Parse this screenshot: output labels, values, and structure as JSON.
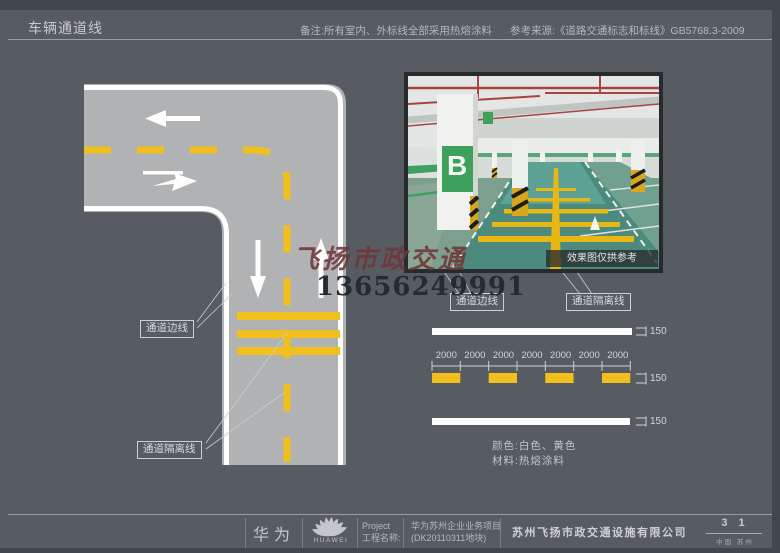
{
  "header": {
    "title": "车辆通道线",
    "note": "备注:所有室内、外标线全部采用热熔涂料",
    "reference": "参考来源:《道路交通标志和标线》GB5768.3-2009"
  },
  "diagram": {
    "callout_edge_line": "通道边线",
    "callout_separator_line": "通道隔离线"
  },
  "photo": {
    "pillar_sign": "B",
    "caption": "效果图仅拱参考",
    "callout_edge_line": "通道边线",
    "callout_separator_line": "通道隔离线"
  },
  "dimensions": {
    "segment_labels": [
      "2000",
      "2000",
      "2000",
      "2000",
      "2000",
      "2000",
      "2000"
    ],
    "width_label": "150"
  },
  "specs": {
    "color_line": "颜色:白色、黄色",
    "material_line": "材料:热熔涂料"
  },
  "watermark": {
    "name": "飞扬市政交通",
    "phone": "13656249991"
  },
  "footer": {
    "huawei_cn": "华为",
    "huawei_en": "HUAWEI",
    "project_label_en": "Project",
    "project_label_cn": "工程名称:",
    "project_name": "华为苏州企业业务项目",
    "project_code": "(DK20110311地块)",
    "company": "苏州飞扬市政交通设施有限公司",
    "page_number": "3 1",
    "location": "中国  苏州"
  },
  "colors": {
    "marking_yellow": "#F1C01D",
    "marking_white": "#FDFDFD",
    "page_background": "#575C63",
    "road_gray": "#B1B2B4"
  }
}
